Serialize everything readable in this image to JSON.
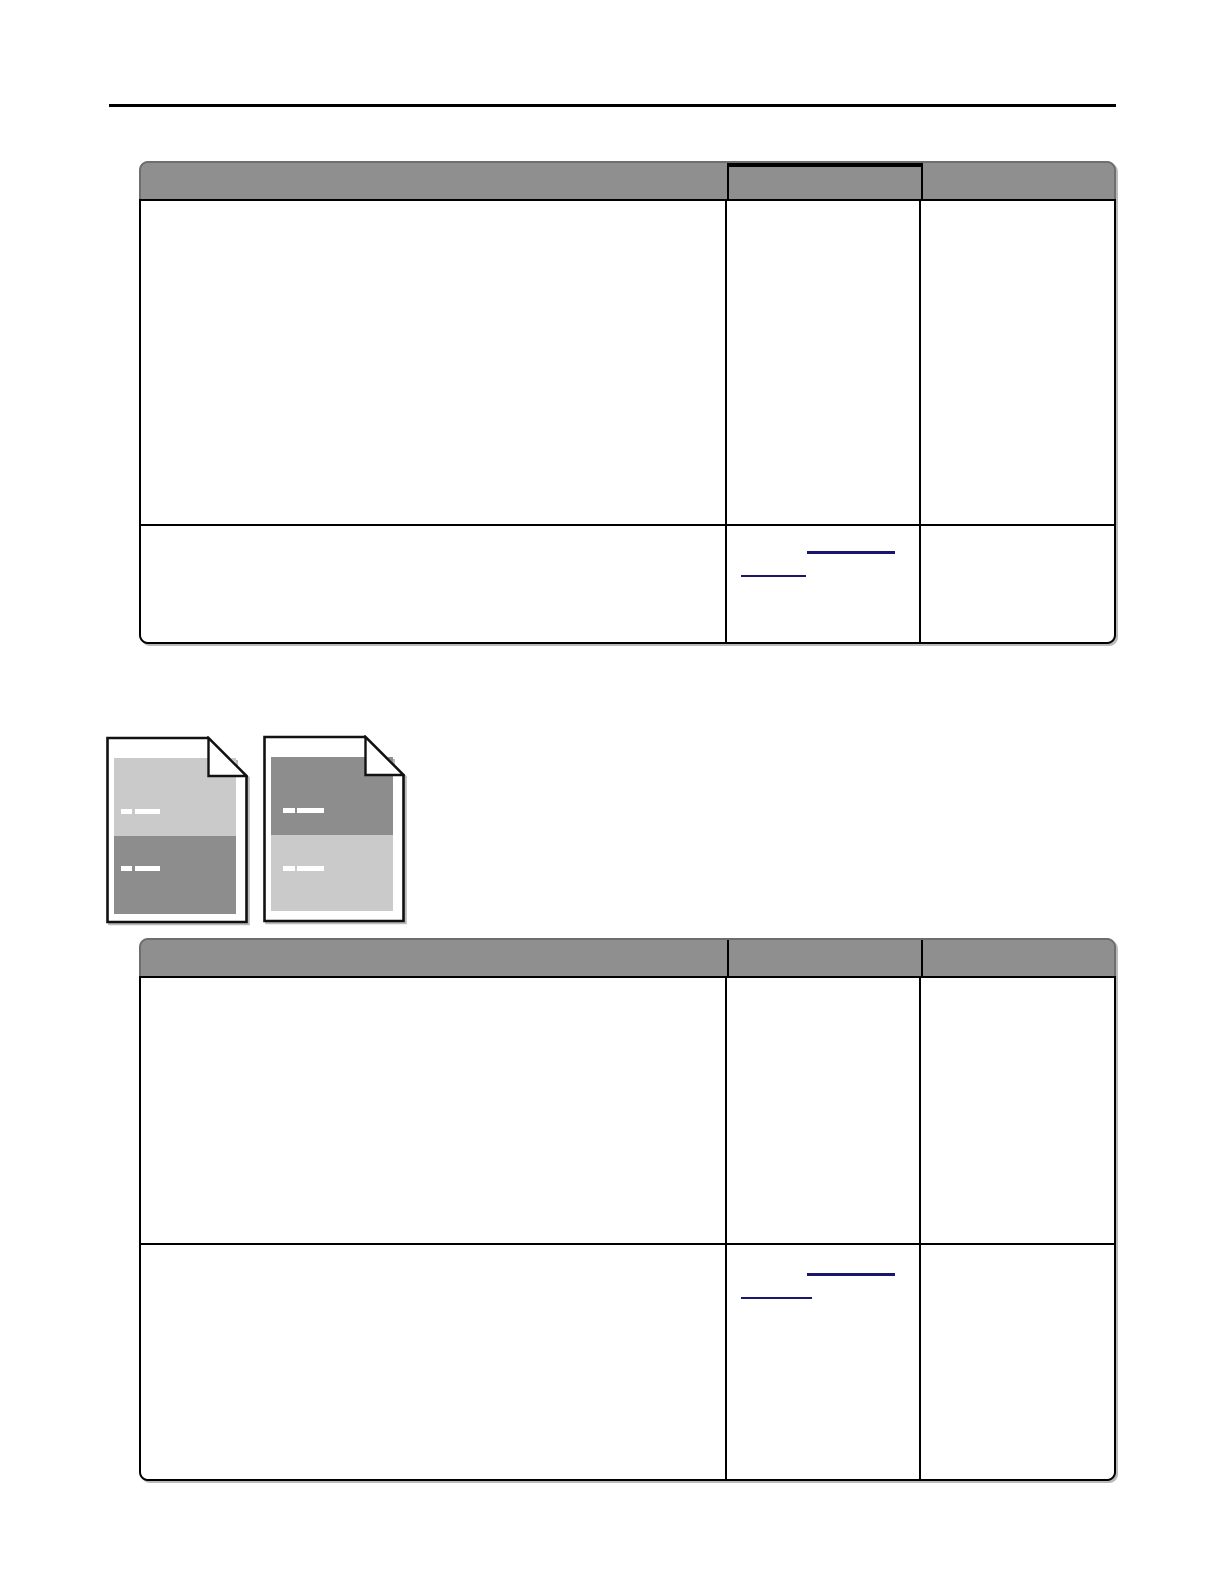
{
  "page": {
    "background": "#ffffff"
  },
  "top_rule": {
    "color": "#000000"
  },
  "colors": {
    "table_header_bg": "#8f8f8f",
    "table_header_edge": "#6e6e6e",
    "table_border": "#000000",
    "link_underline": "#1a1670",
    "shadow": "#b4b4b4",
    "icon_outline": "#111111",
    "icon_page_fill": "#ffffff",
    "icon_dark_block": "#8d8d8d",
    "icon_light_block": "#cacaca",
    "icon_text_dash": "#ffffff"
  },
  "table_1": {
    "header": [
      "",
      "",
      ""
    ],
    "rows": [
      {
        "col1": "",
        "col2": "",
        "col3": ""
      },
      {
        "col1": "",
        "col2_link_1_text": "",
        "col2_link_2_text": "",
        "col3": ""
      }
    ]
  },
  "table_2": {
    "header": [
      "",
      "",
      ""
    ],
    "rows": [
      {
        "col1": "",
        "col2": "",
        "col3": ""
      },
      {
        "col1": "",
        "col2_link_1_text": "",
        "col2_link_2_text": "",
        "col3": ""
      }
    ]
  },
  "icons": [
    {
      "name": "page-light-top-dark-bottom-icon",
      "top_block_color": "#cacaca",
      "bottom_block_color": "#8d8d8d",
      "dash_color": "#ffffff"
    },
    {
      "name": "page-dark-top-light-bottom-icon",
      "top_block_color": "#8d8d8d",
      "bottom_block_color": "#cacaca",
      "dash_color": "#ffffff"
    }
  ]
}
